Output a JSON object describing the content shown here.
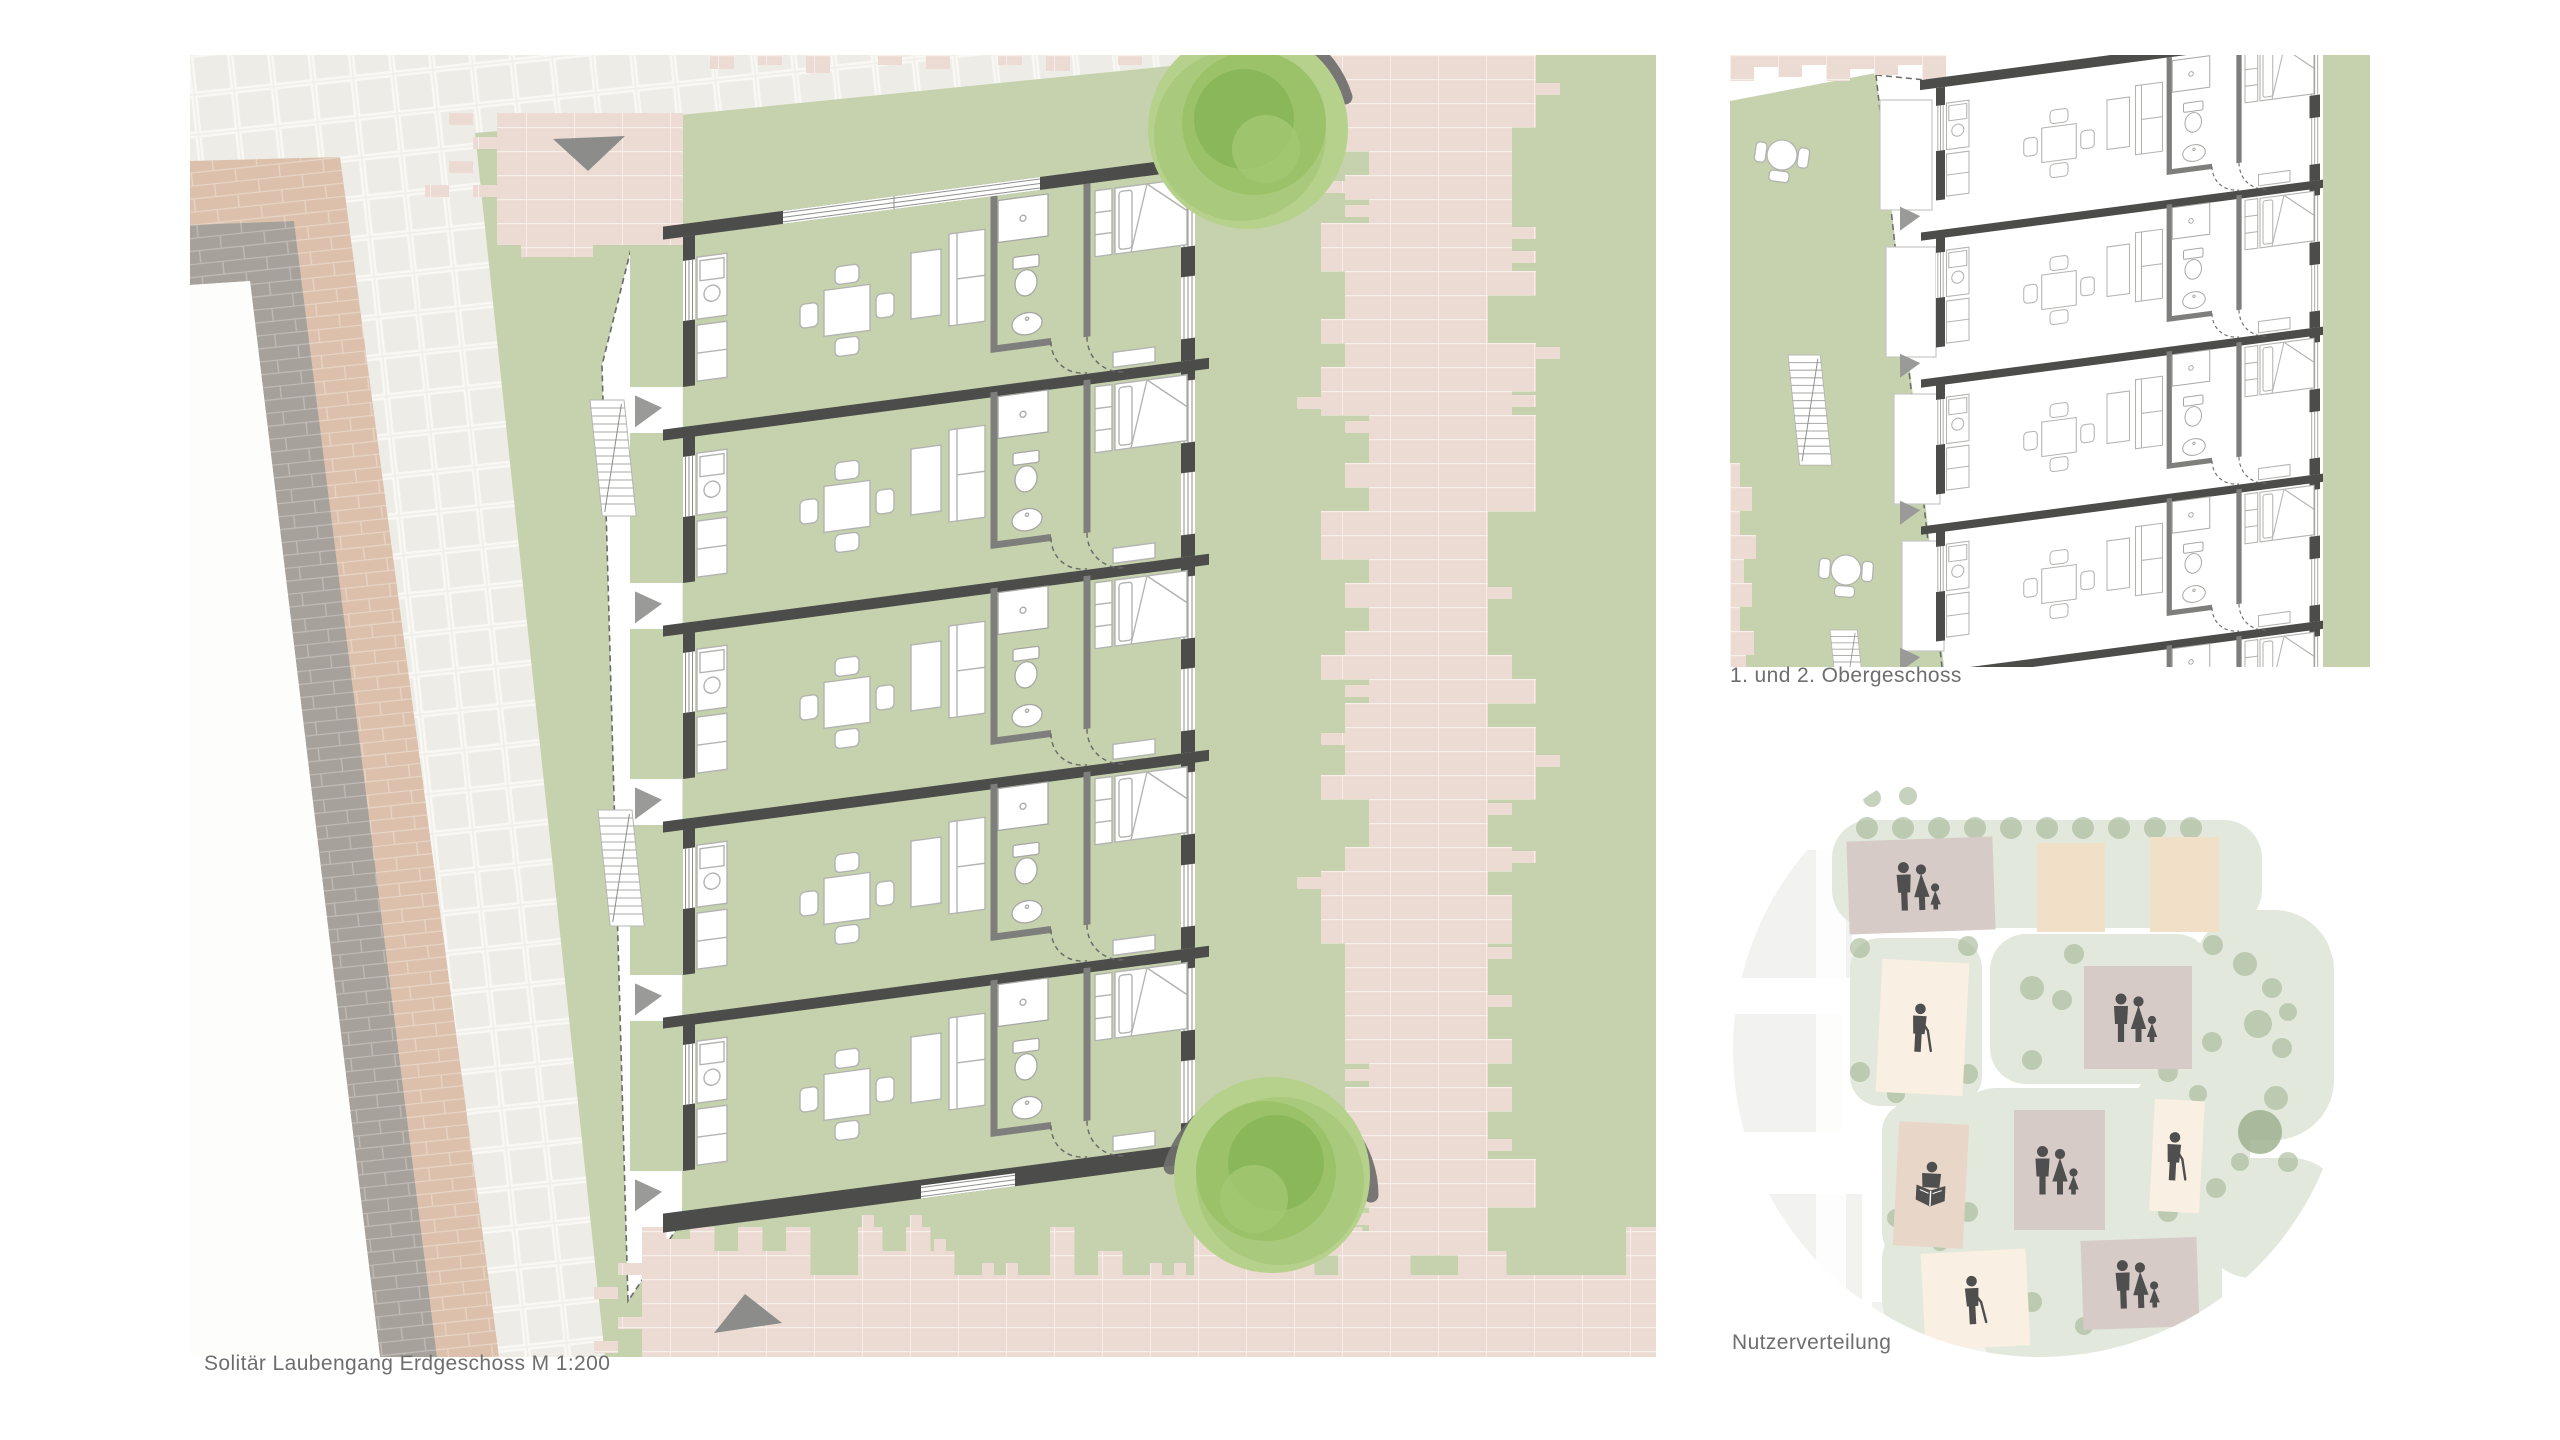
{
  "captions": {
    "main": "Solitär Laubengang Erdgeschoss M 1:200",
    "upper": "1. und 2. Obergeschoss",
    "distribution": "Nutzerverteilung"
  },
  "palette": {
    "lawn": "#c6d2ad",
    "path_pink": "#ecdbd3",
    "paving": "#efeee9",
    "brick_beige": "#dcc0ab",
    "brick_gray": "#a7a19b",
    "wall_dark": "#4c4c4a",
    "wall_mid": "#7e7e7c",
    "furniture": "#b3b3b1",
    "marker_gray": "#8c8c8a",
    "tree_green": "#9ac168",
    "tree_shadow": "#6e6e6c",
    "sage": "#e1e7da",
    "tree_dot": "#a7ba9b",
    "icon": "#4f4f4f",
    "text": "#6e6e6e",
    "block_family": "#d7cbc8",
    "block_single": "#f2dfc8",
    "block_senior": "#f9efe2",
    "block_reader": "#e8d6c9"
  },
  "main_plan": {
    "units": 5,
    "trees": 2,
    "staircases": 2
  },
  "upper_plan": {
    "units_visible": 4
  },
  "user_distribution": {
    "blocks": [
      {
        "type": "family",
        "color": "block_family",
        "x": 116,
        "y": 97,
        "w": 146,
        "h": 93,
        "rot": -2
      },
      {
        "type": "single",
        "color": "block_single",
        "x": 305,
        "y": 101,
        "w": 68,
        "h": 89,
        "rot": 0
      },
      {
        "type": "single",
        "color": "block_single",
        "x": 418,
        "y": 95,
        "w": 69,
        "h": 95,
        "rot": 0
      },
      {
        "type": "senior",
        "color": "block_senior",
        "x": 147,
        "y": 219,
        "w": 87,
        "h": 133,
        "rot": 3
      },
      {
        "type": "family",
        "color": "block_family",
        "x": 352,
        "y": 224,
        "w": 108,
        "h": 103,
        "rot": 0
      },
      {
        "type": "reader",
        "color": "block_reader",
        "x": 164,
        "y": 381,
        "w": 70,
        "h": 124,
        "rot": 3
      },
      {
        "type": "family",
        "color": "block_family",
        "x": 282,
        "y": 368,
        "w": 91,
        "h": 120,
        "rot": 0
      },
      {
        "type": "senior",
        "color": "block_senior",
        "x": 420,
        "y": 358,
        "w": 50,
        "h": 112,
        "rot": 3
      },
      {
        "type": "senior",
        "color": "block_senior",
        "x": 191,
        "y": 509,
        "w": 105,
        "h": 97,
        "rot": -3
      },
      {
        "type": "family",
        "color": "block_family",
        "x": 350,
        "y": 497,
        "w": 116,
        "h": 89,
        "rot": -2
      }
    ]
  }
}
